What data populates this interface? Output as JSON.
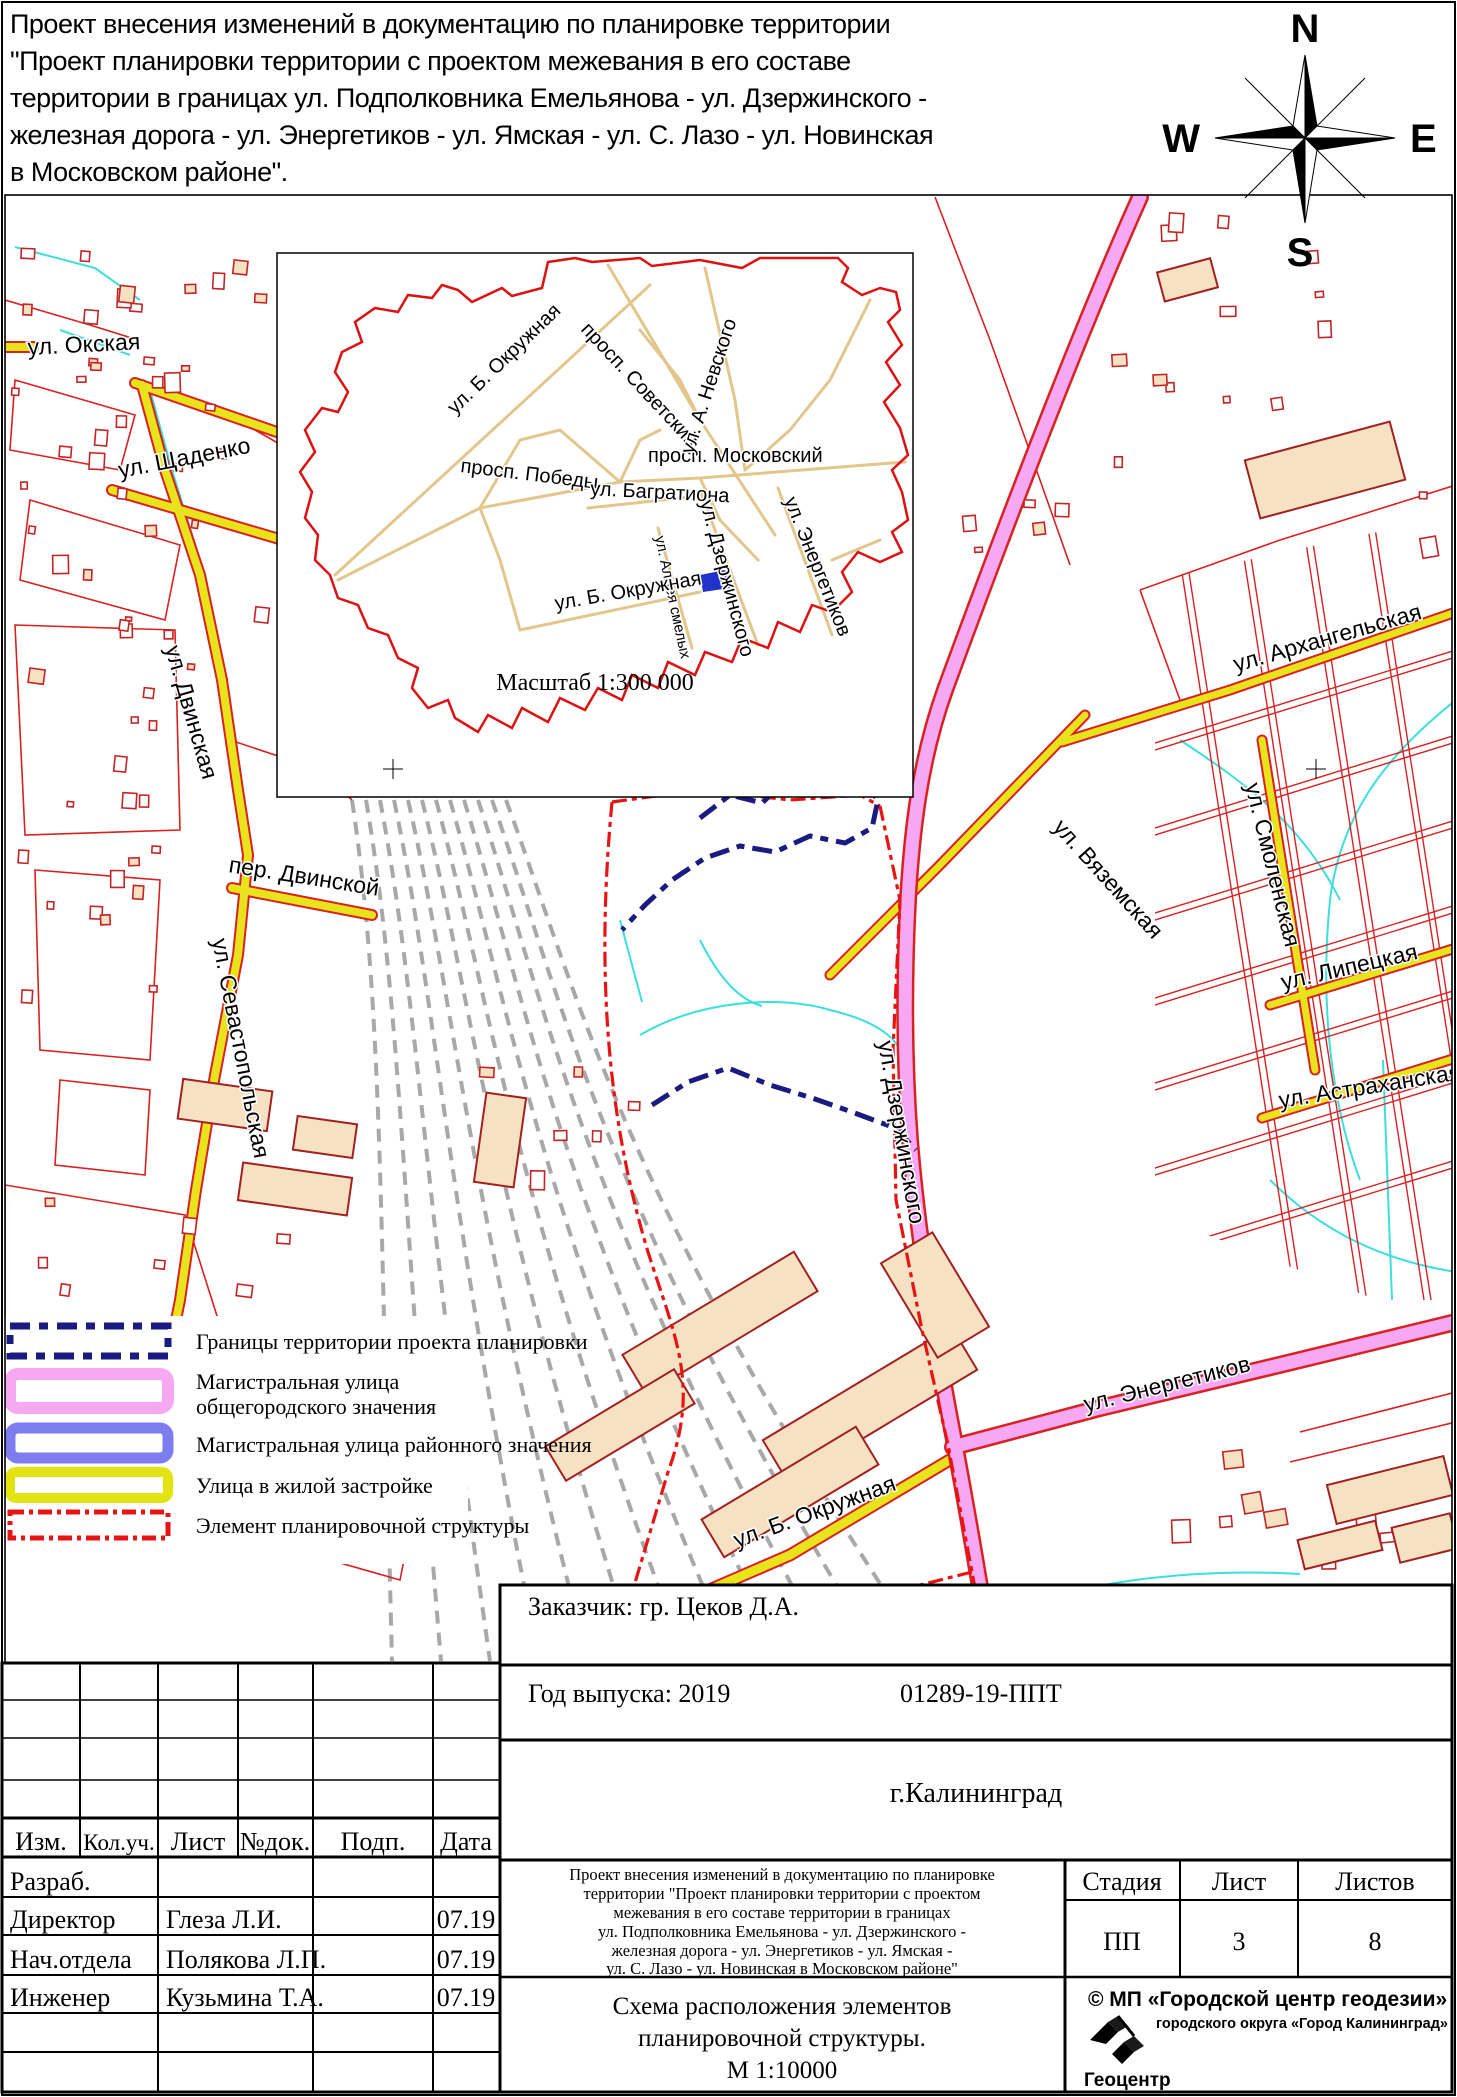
{
  "title": {
    "lines": [
      "Проект внесения изменений в документацию по планировке  территории",
      "\"Проект планировки территории с проектом межевания в его составе",
      "территории в границах  ул. Подполковника Емельянова - ул. Дзержинского -",
      "железная дорога -  ул. Энергетиков - ул. Ямская - ул. С. Лазо - ул. Новинская",
      "в Московском районе\".",
      "Схема расположения элементов планировочной структуры."
    ]
  },
  "compass": {
    "n": "N",
    "e": "E",
    "s": "S",
    "w": "W"
  },
  "inset": {
    "labels": {
      "okruzhnaya_nw": "ул. Б. Окружная",
      "sovetskiy": "просп. Советский",
      "pobedy": "просп. Победы",
      "moskovskiy": "просп. Московский",
      "nevskogo": "ул. А. Невского",
      "bagrationa": "ул. Багратиона",
      "dzerzhinskogo": "ул. Дзержинского",
      "energetikov": "ул. Энергетиков",
      "alleya_smelykh": "ул. Аллея смелых",
      "okruzhnaya_s": "ул. Б. Окружная"
    },
    "scale_caption": "Масштаб 1:300 000"
  },
  "map": {
    "labels": {
      "okskaya": "ул. Окская",
      "shchadenko": "ул. Щаденко",
      "dvinskaya": "ул. Двинская",
      "per_dvinskoy": "пер. Двинской",
      "sevastopolskaya": "ул. Севастопольская",
      "arkhangelskaya": "ул. Архангельская",
      "vyazemskaya": "ул. Вяземская",
      "smolenskaya": "ул. Смоленская",
      "lipetskaya": "ул. Липецкая",
      "astrakhanskaya": "ул. Астраханская",
      "dzerzhinskogo": "ул. Дзержинского",
      "energetikov": "ул. Энергетиков",
      "b_okruzhnaya": "ул. Б. Окружная"
    }
  },
  "legend": {
    "item1": "Границы территории проекта планировки",
    "item2a": "Магистральная улица",
    "item2b": "общегородского значения",
    "item3": "Магистральная улица районного значения",
    "item4": "Улица в жилой застройке",
    "item5": "Элемент планировочной структуры"
  },
  "titleblock": {
    "zakazchik": "Заказчик: гр. Цеков Д.А.",
    "year": "Год выпуска: 2019",
    "code": "01289-19-ППТ",
    "city": "г.Калининград",
    "cols": {
      "izm": "Изм.",
      "koluch": "Кол.уч.",
      "list": "Лист",
      "ndok": "№док.",
      "podp": "Подп.",
      "data": "Дата"
    },
    "rows": [
      {
        "role": "Разраб.",
        "name": "",
        "date": ""
      },
      {
        "role": "Директор",
        "name": "Глеза Л.И.",
        "date": "07.19"
      },
      {
        "role": "Нач.отдела",
        "name": "Полякова Л.П.",
        "date": "07.19"
      },
      {
        "role": "Инженер",
        "name": "Кузьмина Т.А.",
        "date": "07.19"
      }
    ],
    "stage": {
      "h1": "Стадия",
      "h2": "Лист",
      "h3": "Листов",
      "v1": "ПП",
      "v2": "3",
      "v3": "8"
    },
    "desc_lines": [
      "Проект внесения изменений в документацию по планировке",
      "территории \"Проект планировки территории с проектом",
      "межевания в его составе территории в границах",
      "ул. Подполковника Емельянова - ул. Дзержинского -",
      "железная дорога -  ул. Энергетиков - ул. Ямская -",
      "ул. С. Лазо - ул. Новинская в Московском районе\""
    ],
    "scheme_lines": [
      "Схема расположения элементов",
      "планировочной структуры.",
      "М 1:10000"
    ],
    "credit1": "© МП «Городской центр геодезии»",
    "credit2": "городского округа «Город Калининград»",
    "logo": "Геоцентр"
  },
  "colors": {
    "magistral_city": "#f6a8f2",
    "magistral_district": "#7d7df0",
    "residential_street": "#e8e31c",
    "project_boundary": "#1a1a80",
    "element_boundary": "#e81313",
    "map_red": "#d92121",
    "building_fill": "#f6e2c2",
    "inset_road": "#e2c68c",
    "water": "#3cdede",
    "railway": "#a8a8a8"
  }
}
